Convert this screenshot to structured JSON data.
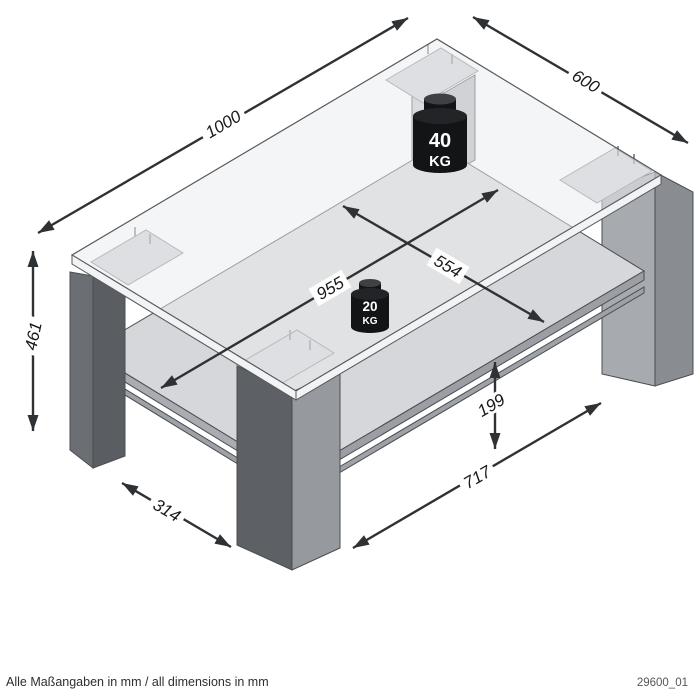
{
  "diagram": {
    "type": "furniture-dimension-drawing",
    "subject": "coffee-table-with-shelf",
    "dimensions": {
      "top_length": "1000",
      "top_width": "600",
      "height": "461",
      "shelf_length": "955",
      "shelf_width": "554",
      "shelf_clearance": "199",
      "leg_span_front": "717",
      "leg_span_side": "314"
    },
    "loads": {
      "top": {
        "value": "40",
        "unit": "KG"
      },
      "shelf": {
        "value": "20",
        "unit": "KG"
      }
    },
    "footer": {
      "note": "Alle Maßangaben in mm / all dimensions in mm",
      "drawing_code": "29600_01"
    },
    "colors": {
      "arrow": "#2f3235",
      "glass": "#e9ebee",
      "leg_dark": "#5c5f64",
      "leg_light": "#a7aaae",
      "weight": "#131416"
    }
  }
}
